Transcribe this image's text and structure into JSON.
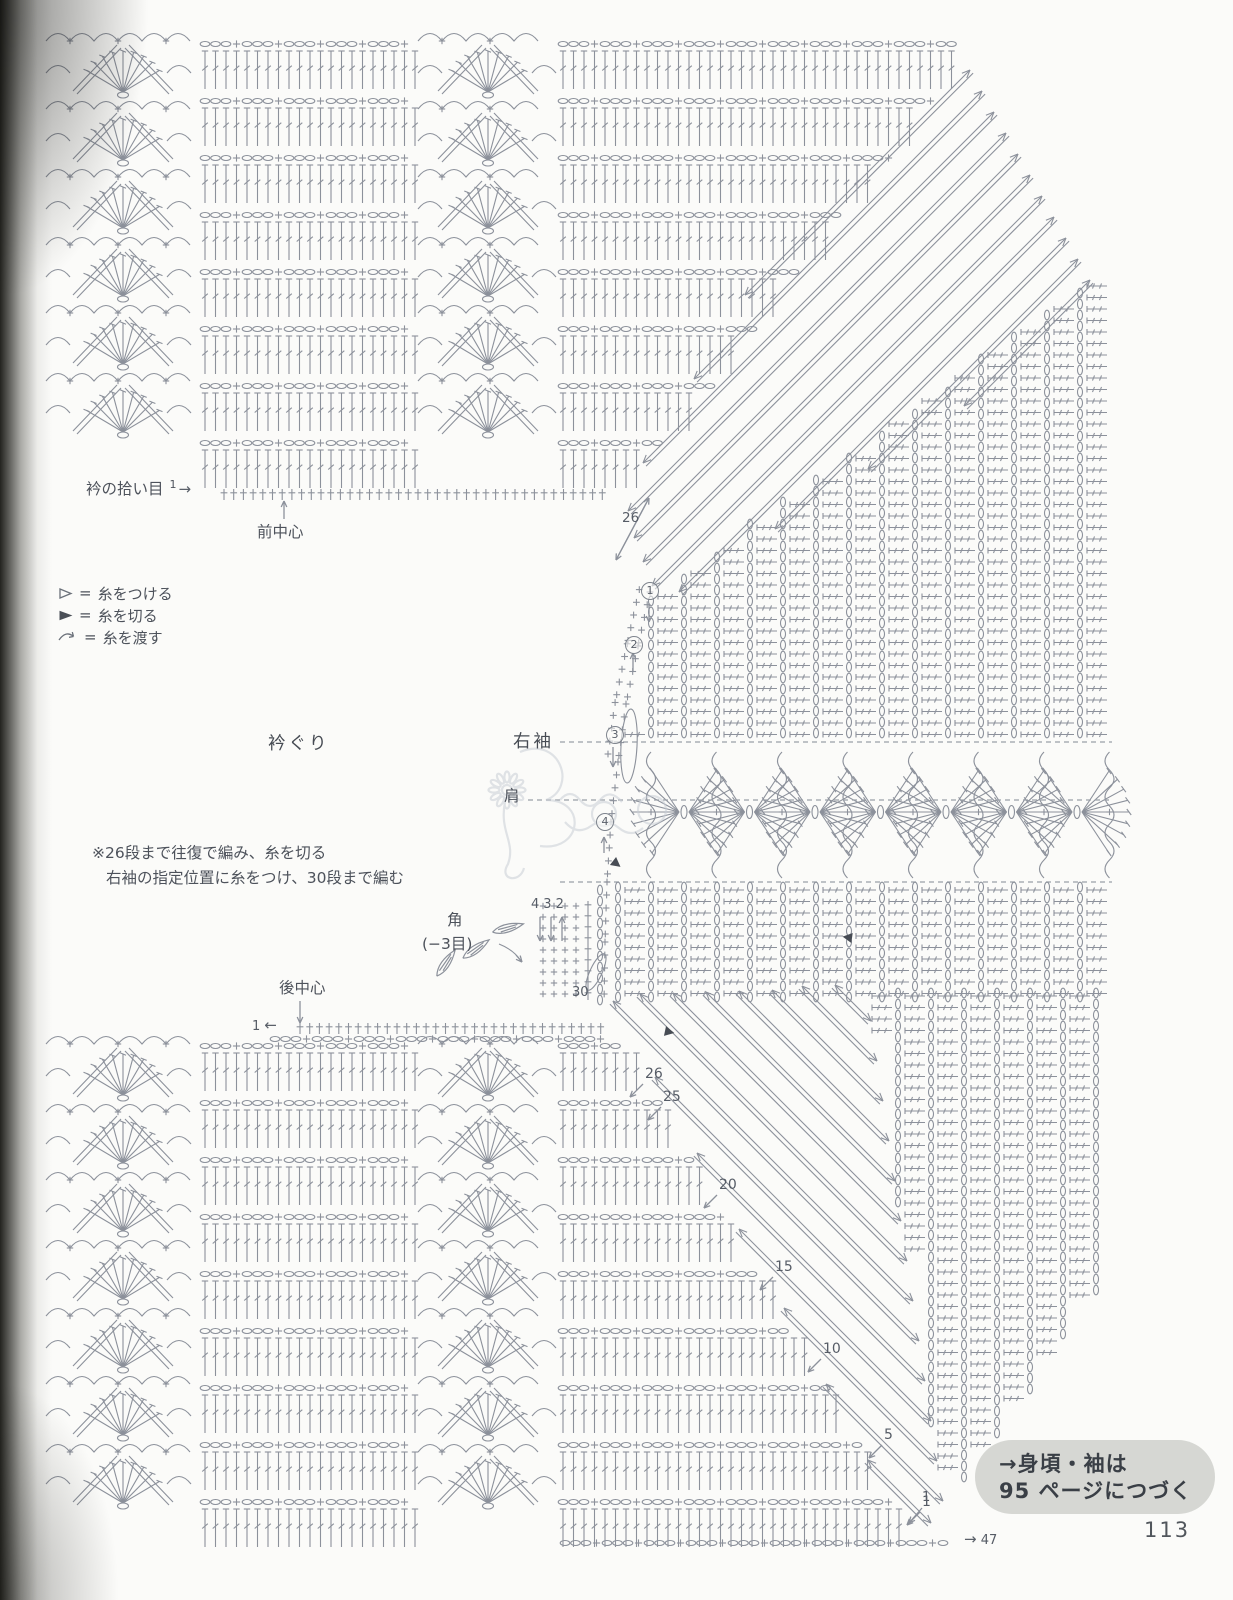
{
  "page": {
    "number": "113",
    "bg": "#fbfbf9",
    "symbol_color": "#8c919b",
    "label_color": "#4d525b",
    "box_bg": "#d6d7d3",
    "dash_color": "#9aa0a8"
  },
  "header_row": {
    "collar_pickup": "衿の拾い目",
    "row_start": "1",
    "arrow": "→"
  },
  "front_center": "前中心",
  "back_center": "後中心",
  "back_center_row": {
    "row_start": "1",
    "arrow": "←"
  },
  "legend": {
    "equals": "=",
    "items": [
      {
        "icon": "attach-yarn-icon",
        "label": "糸をつける"
      },
      {
        "icon": "cut-yarn-icon",
        "label": "糸を切る"
      },
      {
        "icon": "carry-yarn-icon",
        "label": "糸を渡す"
      }
    ]
  },
  "section_labels": {
    "neckline": "衿ぐり",
    "right_sleeve": "右袖",
    "shoulder": "肩"
  },
  "notes": {
    "line1": "※26段まで往復で編み、糸を切る",
    "line2": "右袖の指定位置に糸をつけ、30段まで編む"
  },
  "corner": {
    "label": "角",
    "sub": "(−3目)",
    "arrow_digits": [
      "4",
      "3",
      "2"
    ]
  },
  "row_markers": {
    "neck_top": "26",
    "sleeve_start": "30",
    "steps": [
      "26",
      "25",
      "20",
      "15",
      "10",
      "5",
      "1"
    ],
    "circled_steps": [
      "1",
      "2",
      "3",
      "4"
    ],
    "bottom_row": "1",
    "bottom_arrow": "→",
    "bottom_count": "47"
  },
  "continuation": {
    "line1": "→身頃・袖は",
    "line2": "95 ページにつづく"
  }
}
